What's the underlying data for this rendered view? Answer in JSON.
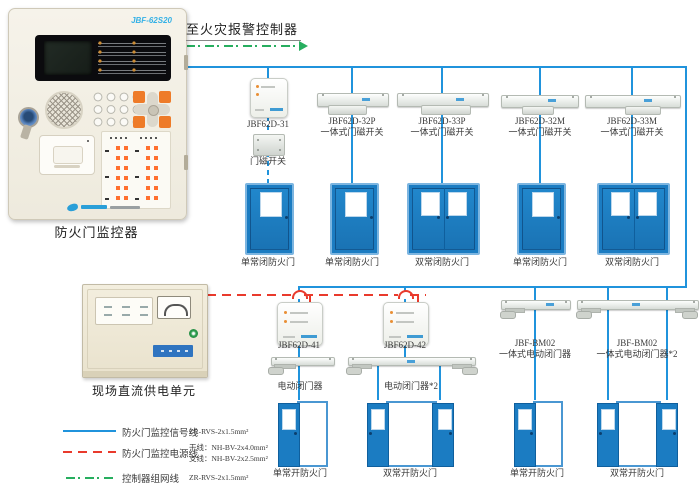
{
  "note_to_fire_alarm": "至火灾报警控制器",
  "panel": {
    "model": "JBF-62S20",
    "label": "防火门监控器"
  },
  "power_unit": {
    "label": "现场直流供电单元"
  },
  "magswitch_label": "门磁开关",
  "row1_devices": [
    {
      "model": "JBF62D-31",
      "name": ""
    },
    {
      "model": "JBF62D-32P",
      "name": "一体式门磁开关"
    },
    {
      "model": "JBF62D-33P",
      "name": "一体式门磁开关"
    },
    {
      "model": "JBF62D-32M",
      "name": "一体式门磁开关"
    },
    {
      "model": "JBF62D-33M",
      "name": "一体式门磁开关"
    }
  ],
  "row1_doors": [
    "单常闭防火门",
    "单常闭防火门",
    "双常闭防火门",
    "单常闭防火门",
    "双常闭防火门"
  ],
  "row2_devices": [
    {
      "model": "JBF62D-41",
      "name": "电动闭门器"
    },
    {
      "model": "JBF62D-42",
      "name": "电动闭门器*2"
    },
    {
      "model": "JBF-BM02",
      "name": "一体式电动闭门器"
    },
    {
      "model": "JBF-BM02",
      "name": "一体式电动闭门器*2"
    }
  ],
  "row2_doors": [
    "单常开防火门",
    "双常开防火门",
    "单常开防火门",
    "双常开防火门"
  ],
  "legend": {
    "signal": {
      "label": "防火门监控信号线",
      "spec": "ZR-RVS-2x1.5mm²"
    },
    "power": {
      "label": "防火门监控电源线",
      "spec_trunk": "干线：NH-BV-2x4.0mm²",
      "spec_branch": "支线：NH-BV-2x2.5mm²"
    },
    "network": {
      "label": "控制器组网线",
      "spec": "ZR-RVS-2x1.5mm²"
    }
  },
  "colors": {
    "signal_line": "#2093dc",
    "power_line": "#e93a2c",
    "network_line": "#27ae5f",
    "door_blue": "#1b7cc2"
  }
}
